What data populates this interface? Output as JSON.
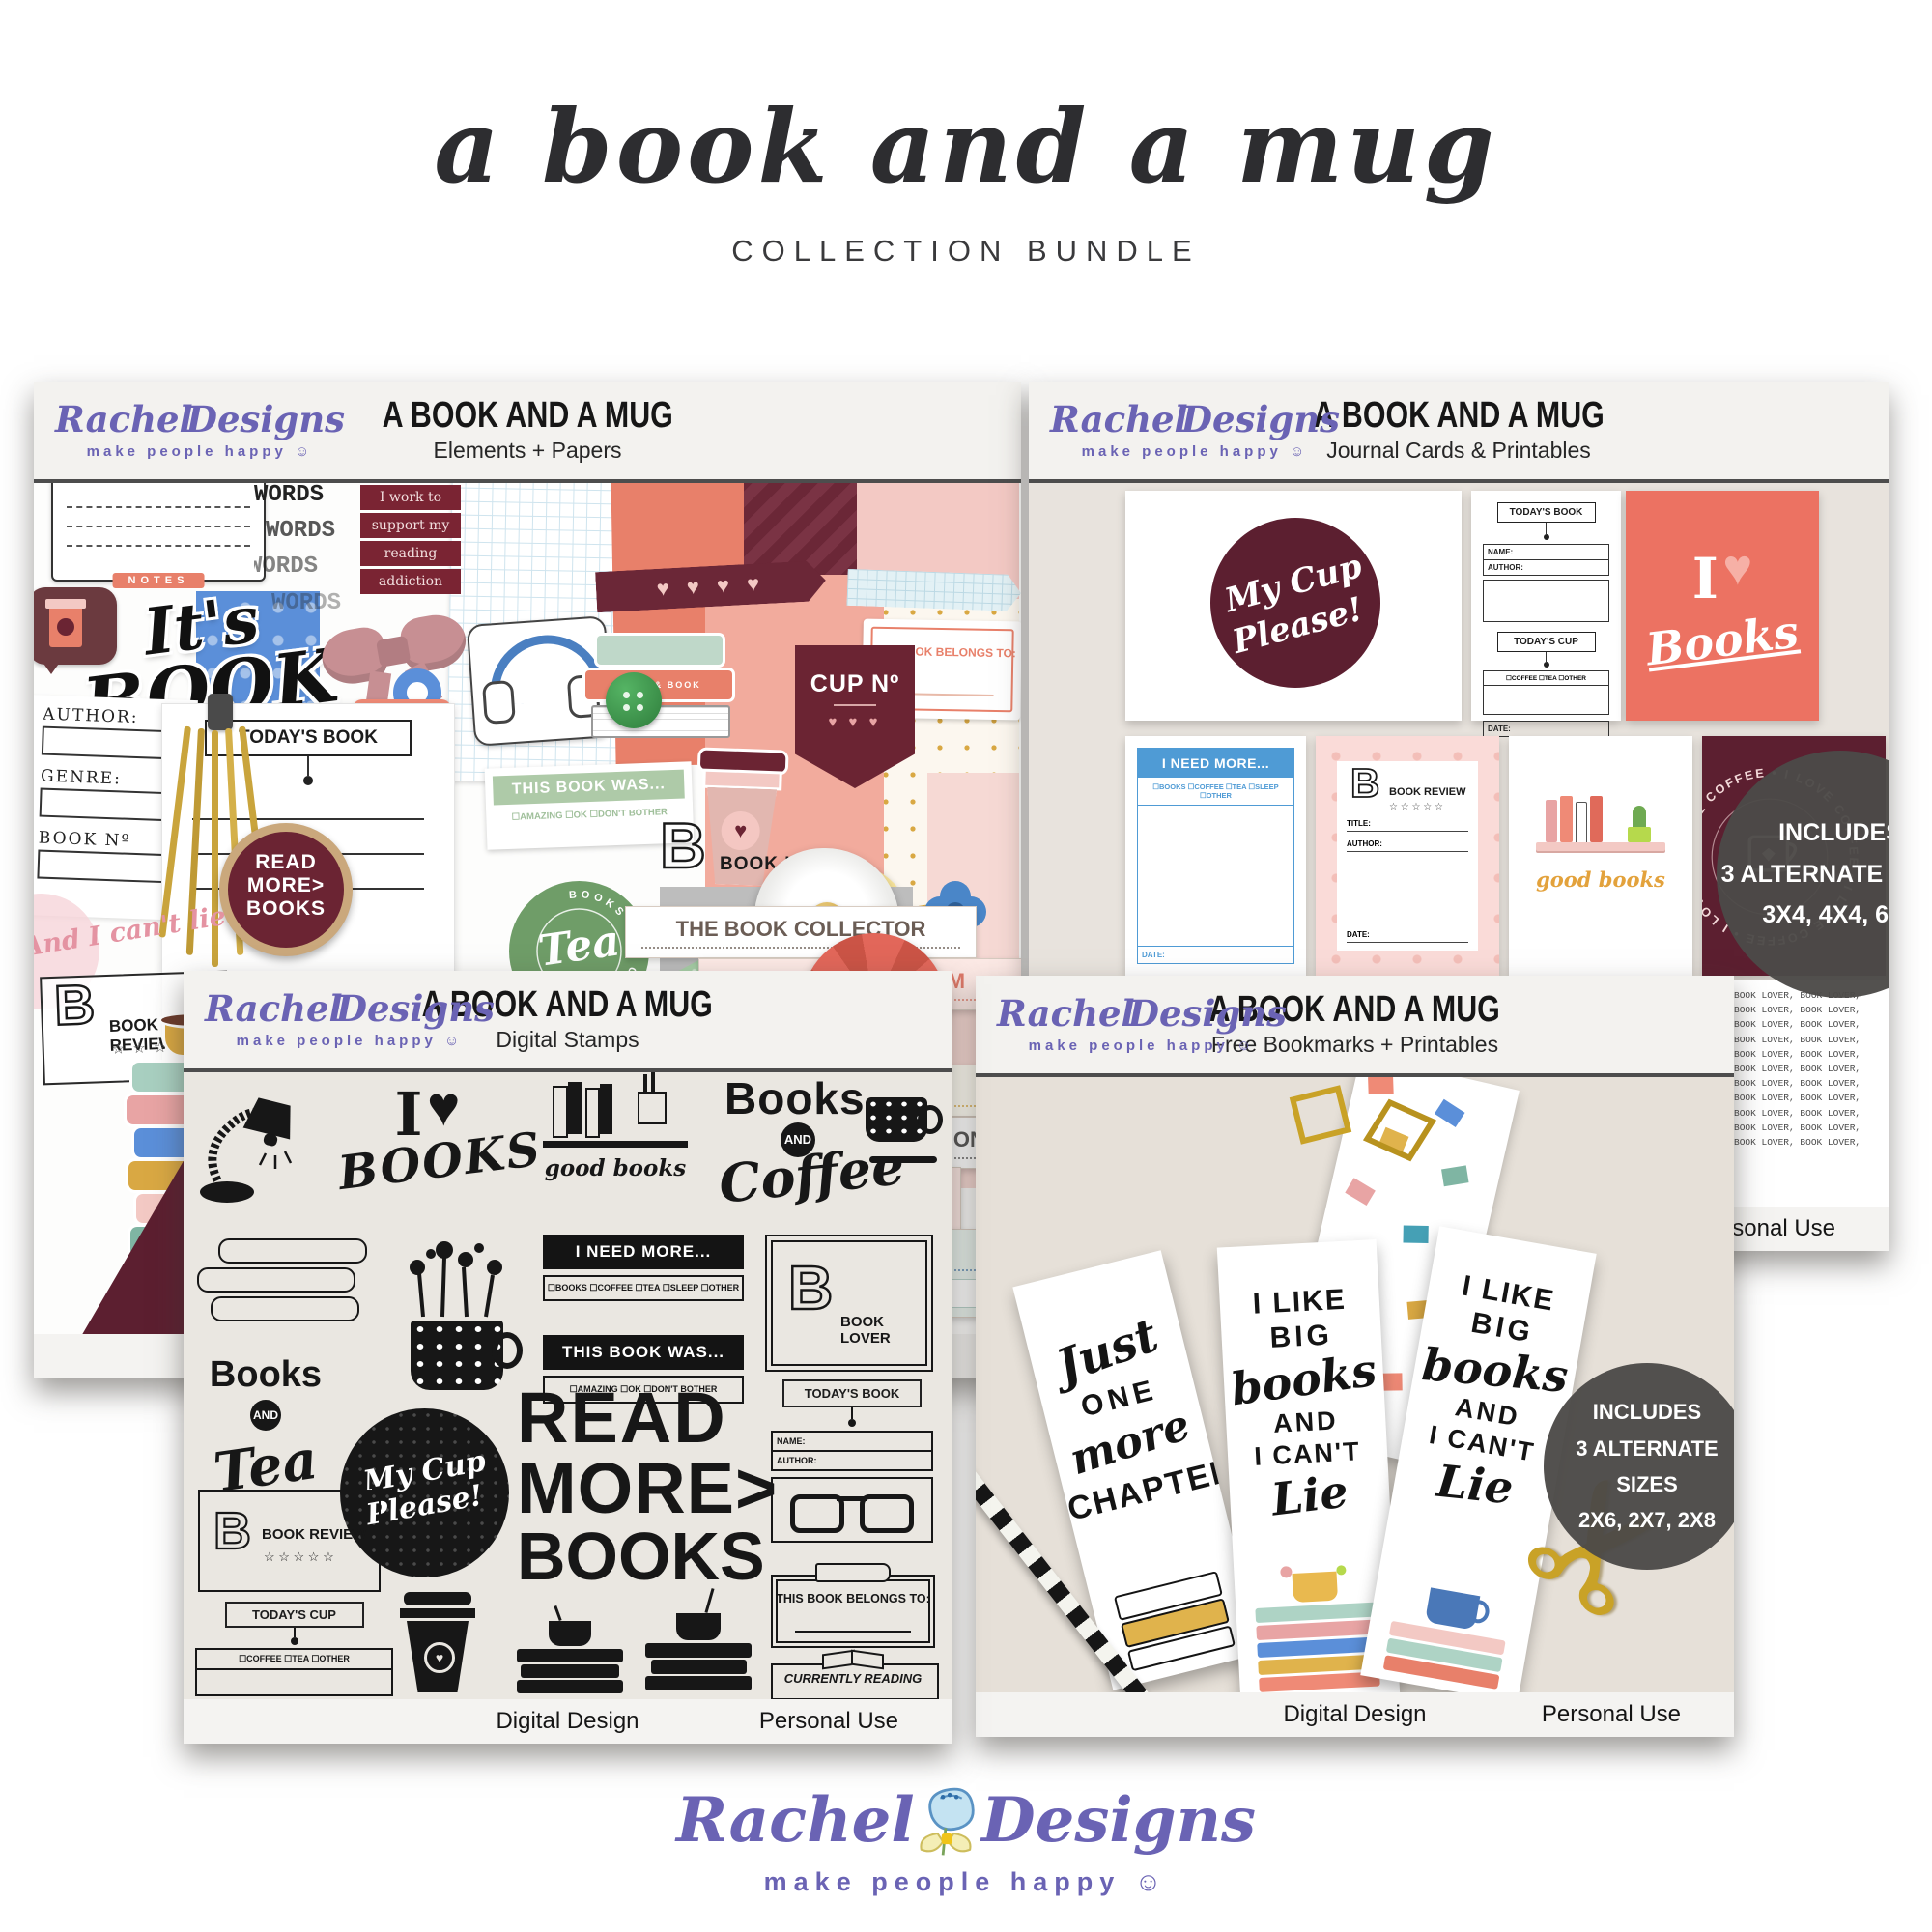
{
  "colors": {
    "brand_purple": "#6a63b4",
    "logo_blue": "#c4e3f2",
    "coral": "#ec7262",
    "maroon": "#5c1f30",
    "maroon_light": "#7a2433",
    "sage": "#a9c8a4",
    "journal_blue": "#4f9bd5",
    "gold": "#c9a227",
    "badge_gray": "#4c4a48",
    "booked_yellow": "#f7e49b",
    "tea_green": "#6f9d68"
  },
  "header": {
    "script_title": "a book and a mug",
    "subtitle": "COLLECTION BUNDLE"
  },
  "brand": {
    "first": "Rachel",
    "second": "Designs",
    "tagline": "make people happy",
    "smiley": "☺"
  },
  "panels": {
    "elements": {
      "title": "A BOOK AND A MUG",
      "subtitle": "Elements + Papers"
    },
    "journal": {
      "title": "A BOOK AND A MUG",
      "subtitle": "Journal Cards & Printables",
      "footer_right": "Personal Use",
      "badge": [
        "INCLUDES",
        "3 ALTERNATE SIZES",
        "3X4, 4X4, 6X4"
      ]
    },
    "stamps": {
      "title": "A BOOK AND A MUG",
      "subtitle": "Digital Stamps",
      "footer_left": "Digital Design",
      "footer_right": "Personal Use"
    },
    "bookmarks": {
      "title": "A BOOK AND A MUG",
      "subtitle": "Free Bookmarks + Printables",
      "footer_left": "Digital Design",
      "footer_right": "Personal Use",
      "badge": [
        "INCLUDES",
        "3 ALTERNATE SIZES",
        "2X6, 2X7, 2X8"
      ]
    }
  },
  "collage": {
    "notes": "NOTES",
    "words": "WORDS",
    "banner": [
      "I work to",
      "support my",
      "reading",
      "addiction"
    ],
    "oclock": [
      "It's",
      "BOOK",
      "O'CLOCK"
    ],
    "author": "AUTHOR:",
    "genre": "GENRE:",
    "book_no": "BOOK Nº",
    "todays_book": "TODAY'S BOOK",
    "todays_cup": "TODAY'S CUP",
    "cup_checks": "☐ COFFEE    ☐ TEA",
    "read_more": [
      "READ",
      "MORE>",
      "BOOKS"
    ],
    "tea_arc": "BOOKS AND CUP OF",
    "tea": "Tea",
    "this_book_was": "THIS BOOK WAS...",
    "was_checks": "☐AMAZING      ☐OK      ☐DON'T BOTHER",
    "cup_no": "CUP Nº",
    "hearts": "♥ ♥ ♥",
    "washi_hearts": "♥    ♥    ♥    ♥",
    "belongs": "THIS BOOK BELONGS TO:",
    "booked": "Booked",
    "b": "B",
    "book_lover": "BOOK LOVER",
    "book_review": "BOOK REVIEW",
    "stars": "☆ ☆ ☆ ☆ ☆",
    "lie": "And I can't lie",
    "good_books": "good  books",
    "book_and_book": "BOOK & BOOK",
    "cup_word": "CUP",
    "tea_log": "#TEA LOG",
    "tags": [
      "THE BOOK COLLECTOR",
      "THE BOOKWORM",
      "LIVES IN THE SHOP",
      "NEVER COMPLETES",
      "FINISHES TOO SOON",
      "TAKES FOREVER TO CHOOSE A BOOK",
      "THE BORROWER"
    ],
    "yes_no": "☐ YES         ☐ NO"
  },
  "journal": {
    "my_cup": [
      "My Cup",
      "Please!"
    ],
    "todays_book": "TODAY'S BOOK",
    "name": "NAME:",
    "author": "AUTHOR:",
    "todays_cup": "TODAY'S CUP",
    "cup_checks": "☐COFFEE  ☐TEA  ☐OTHER",
    "date": "DATE:",
    "i": "I",
    "heart": "♥",
    "books": "Books",
    "need": "I NEED MORE...",
    "need_checks": "☐BOOKS ☐COFFEE ☐TEA ☐SLEEP ☐OTHER",
    "b": "B",
    "review": "BOOK REVIEW",
    "stars": "☆ ☆ ☆ ☆ ☆",
    "title": "TITLE:",
    "good_books": "good  books",
    "ring": "I LOVE COFFEE • I LOVE COFFEE • I LOVE COFFEE • I LOVE COFFEE •",
    "lover_paper": "BOOK LOVER, BOOK LOVER, BOOK LOVER, BOOK LOVER, BOOK LOVER, BOOK LOVER, BOOK LOVER, BOOK LOVER, BOOK LOVER, BOOK LOVER, BOOK LOVER, BOOK LOVER, BOOK LOVER, BOOK LOVER, BOOK LOVER, BOOK LOVER, BOOK LOVER, BOOK LOVER, BOOK LOVER, BOOK LOVER, BOOK LOVER, BOOK LOVER, BOOK LOVER, BOOK LOVER,"
  },
  "stamps": {
    "i": "I",
    "heart": "♥",
    "books_script": "BOOKS",
    "good_books": "good  books",
    "books": "Books",
    "and": "AND",
    "coffee": "Coffee",
    "tea": "Tea",
    "need": "I NEED MORE...",
    "need_checks": "☐BOOKS ☐COFFEE ☐TEA ☐SLEEP ☐OTHER",
    "was": "THIS BOOK WAS...",
    "was_checks": "☐AMAZING   ☐OK   ☐DON'T BOTHER",
    "my_cup": [
      "My Cup",
      "Please!"
    ],
    "read": [
      "READ",
      "MORE>",
      "BOOKS"
    ],
    "b": "B",
    "lover": "BOOK LOVER",
    "review": "BOOK REVIEW",
    "stars": "☆ ☆ ☆ ☆ ☆",
    "todays_book": "TODAY'S BOOK",
    "name": "NAME:",
    "author": "AUTHOR:",
    "todays_cup": "TODAY'S CUP",
    "cup_checks": "☐COFFEE  ☐TEA   ☐OTHER",
    "date": "DATE:",
    "belongs": "THIS BOOK BELONGS TO:",
    "current": "CURRENTLY READING"
  },
  "bookmarks": {
    "bm1": [
      "Just",
      "ONE",
      "more",
      "CHAPTER"
    ],
    "bm2": [
      "I LIKE",
      "BIG",
      "books",
      "AND",
      "I CAN'T",
      "Lie"
    ]
  }
}
